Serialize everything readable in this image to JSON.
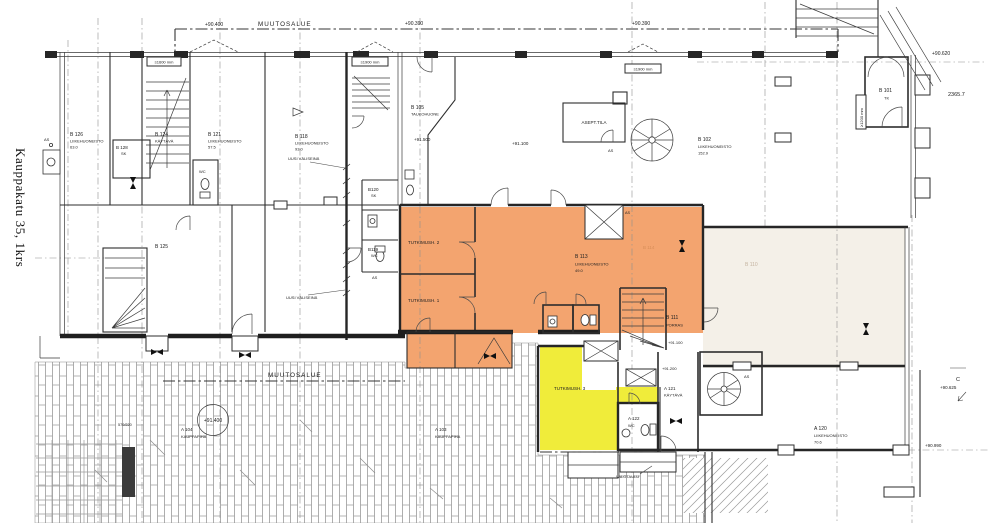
{
  "title": {
    "street_label": "Kauppakatu 35, 1krs"
  },
  "colors": {
    "highlight_orange": "#F3A46F",
    "highlight_yellow": "#F0EC3A",
    "highlight_pale": "#F4F0E8",
    "line": "#2d2d2d"
  },
  "annotations": {
    "muutosalue": "MUUTOSALUE",
    "elev_top_left": "+90.400",
    "elev_top_mid": "+90.390",
    "elev_corner": "+90.620",
    "dim_corner": "2365.7",
    "win_a": "≥1600 mm",
    "win_b": "≥1900 mm",
    "dim_v": "≥1200 mm",
    "uusi_valiseina": "UUSI VÄLISEINÄ",
    "lvl_91500": "+91.500",
    "lvl_91100": "+91.100",
    "lvl_91200": "+91.200",
    "lvl_91400": "+91.400",
    "c_mark": "C",
    "lvl_90625": "+90.625",
    "lvl_90990": "+90.990",
    "dim_570": "570/220",
    "valotaulu": "VALOTAULU",
    "as_marker": "AS"
  },
  "rooms": [
    {
      "id": "B 126",
      "type": "LIIKEHUONEISTO",
      "area": "63.0"
    },
    {
      "id": "B 128",
      "type": "SK"
    },
    {
      "id": "B 124",
      "type": "KÄYTÄVÄ"
    },
    {
      "id": "B 121",
      "type": "LIIKEHUONEISTO",
      "area": "57.5"
    },
    {
      "id": "WC"
    },
    {
      "id": "B 125"
    },
    {
      "id": "B 118",
      "type": "LIIKEHUONEISTO",
      "area": "93.0"
    },
    {
      "id": "B120",
      "type": "SK"
    },
    {
      "id": "B119",
      "type": "WC"
    },
    {
      "id": "B 105",
      "type": "TAUKOHUONE"
    },
    {
      "id": "ASEPT.TILA"
    },
    {
      "id": "B 102",
      "type": "LIIKEHUONEISTO",
      "area": "152.9"
    },
    {
      "id": "B 101",
      "type": "TK"
    },
    {
      "id": "TUTKIMUSH. 2"
    },
    {
      "id": "TUTKIMUSH. 1"
    },
    {
      "id": "B 113",
      "type": "LIIKEHUONEISTO",
      "area": "49.0"
    },
    {
      "id": "B 114"
    },
    {
      "id": "B 110"
    },
    {
      "id": "B 111",
      "type": "PORRAS",
      "level": "+91.100"
    },
    {
      "id": "A 121",
      "type": "KÄYTÄVÄ"
    },
    {
      "id": "A 122",
      "type": "WC"
    },
    {
      "id": "TUTKIMUSH. 3"
    },
    {
      "id": "A 103",
      "type": "KAUPPAPIHA"
    },
    {
      "id": "A 104",
      "type": "KAUPPAPIHA"
    },
    {
      "id": "A 120",
      "type": "LIIKEHUONEISTO",
      "area": "70.6"
    }
  ]
}
